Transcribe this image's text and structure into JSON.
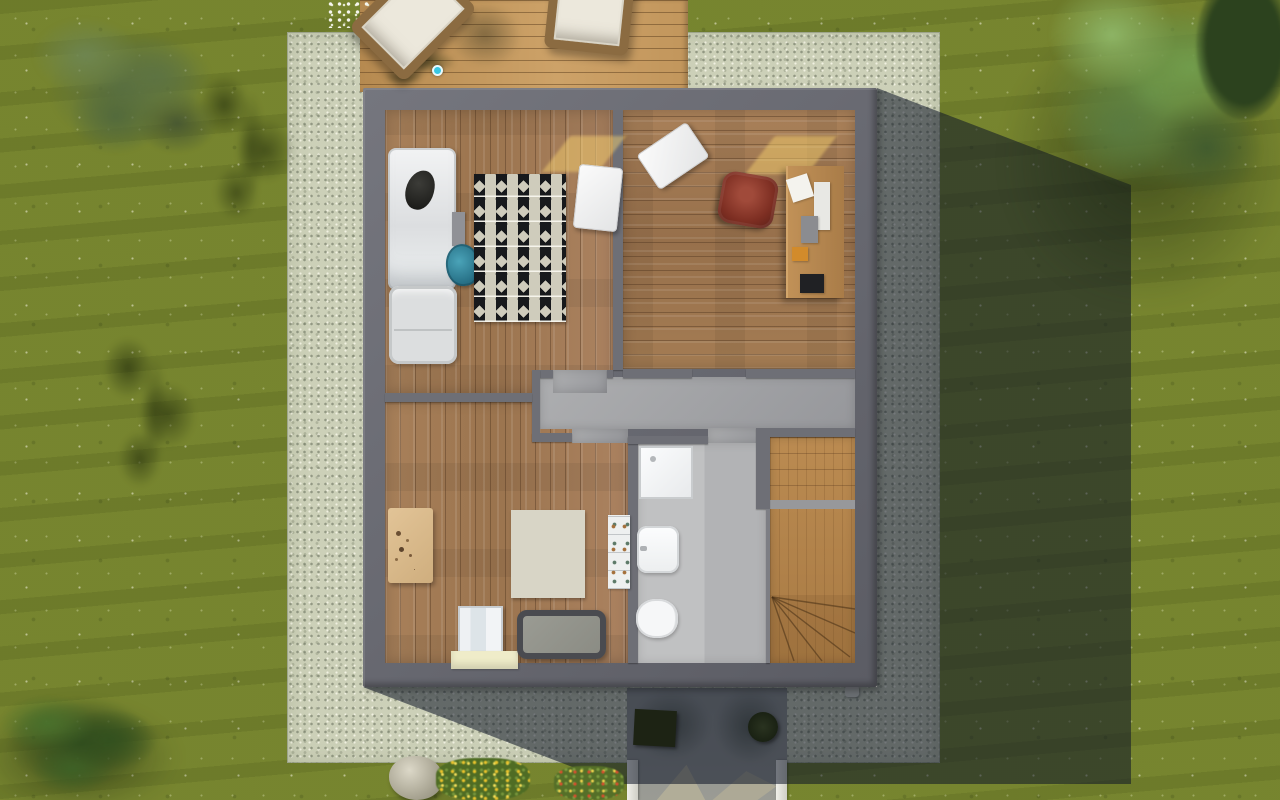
{
  "scene": {
    "view": "top-down-3d-render",
    "subject": "house-upper-floor-with-garden"
  },
  "palette": {
    "grass": "#75832e",
    "gravel": "#ccd0b8",
    "exterior_wall": "#65666e",
    "interior_wall": "#6e6f76",
    "wood_floor": "#a77f57",
    "deck_wood": "#c1955c",
    "hall_floor": "#a3a4a7",
    "bath_floor": "#b8b9bb",
    "stairs_wood": "#b5854d",
    "shadow": "rgba(13,20,38,0.55)",
    "camera_marker": "#39c7e3",
    "rug_zigzag_dark": "#17191c",
    "rug_zigzag_light": "#cfccbc"
  },
  "rug_patch_cells": [
    "#5d7a68",
    "#e8e6dd",
    "#6c8873",
    "#dfdfd6",
    "#c59056",
    "#d9ddd2",
    "#e4e2d8",
    "#c99a60",
    "#dcdcd2",
    "#c88f52",
    "#ece9df",
    "#567463",
    "#e7e5da",
    "#d8d8ce",
    "#c79355",
    "#e3e0d5"
  ],
  "objects": [
    {
      "name": "tree-shadow-upper-left",
      "cls": "shadow-blob",
      "x": 190,
      "y": 66,
      "w": 122,
      "h": 176,
      "interactable": false
    },
    {
      "name": "tree-shadow-middle-left",
      "cls": "shadow-blob",
      "x": 95,
      "y": 328,
      "w": 118,
      "h": 182,
      "interactable": false
    },
    {
      "name": "tree-shade-under-right-tree",
      "cls": "shade-soft",
      "x": 1000,
      "y": 10,
      "w": 290,
      "h": 300,
      "interactable": false
    },
    {
      "name": "bush-shadow",
      "cls": "shade-soft",
      "x": -25,
      "y": 700,
      "w": 205,
      "h": 115,
      "interactable": false
    },
    {
      "name": "lounger-shadow",
      "cls": "shade-soft-sm",
      "x": 448,
      "y": 2,
      "w": 74,
      "h": 66,
      "rot": 12,
      "interactable": false
    },
    {
      "name": "deck-branch-shadow",
      "cls": "shadow-blob",
      "x": 362,
      "y": 32,
      "w": 110,
      "h": 62,
      "interactable": false
    },
    {
      "name": "boulder",
      "cls": "boulder",
      "x": 389,
      "y": 756,
      "w": 54,
      "h": 44,
      "interactable": true
    },
    {
      "name": "flowerbed-yellow",
      "cls": "flowerbed-yellow",
      "x": 436,
      "y": 758,
      "w": 94,
      "h": 42,
      "interactable": true
    },
    {
      "name": "flowerbed-mixed",
      "cls": "flowerbed-mixed",
      "x": 554,
      "y": 766,
      "w": 70,
      "h": 34,
      "interactable": true
    },
    {
      "name": "bush-bottom-left",
      "cls": "bush",
      "x": -18,
      "y": 676,
      "w": 205,
      "h": 132,
      "interactable": true
    },
    {
      "name": "white-flowers-top",
      "cls": "flowers-white",
      "x": 326,
      "y": 0,
      "w": 48,
      "h": 28,
      "interactable": false
    },
    {
      "name": "sun-patch-bedroom",
      "cls": "sun-patch",
      "x": 556,
      "y": 136,
      "w": 56,
      "h": 36,
      "interactable": false
    },
    {
      "name": "bed",
      "cls": "bed",
      "x": 388,
      "y": 148,
      "w": 68,
      "h": 142,
      "interactable": true
    },
    {
      "name": "cat-on-bed",
      "cls": "cat",
      "x": 406,
      "y": 170,
      "w": 28,
      "h": 40,
      "rot": 14,
      "interactable": true
    },
    {
      "name": "bedside-table",
      "cls": "side-table",
      "x": 452,
      "y": 212,
      "w": 13,
      "h": 34,
      "interactable": true
    },
    {
      "name": "teal-chair",
      "cls": "chair-teal",
      "x": 446,
      "y": 244,
      "w": 34,
      "h": 42,
      "rot": -8,
      "interactable": true
    },
    {
      "name": "armchair",
      "cls": "armchair",
      "x": 389,
      "y": 286,
      "w": 68,
      "h": 78,
      "interactable": true
    },
    {
      "name": "zigzag-rug",
      "cls": "rug-zigzag",
      "x": 474,
      "y": 174,
      "w": 92,
      "h": 148,
      "interactable": true
    },
    {
      "name": "bedroom-white-table",
      "cls": "table-white",
      "x": 576,
      "y": 166,
      "w": 44,
      "h": 64,
      "rot": 6,
      "interactable": true
    },
    {
      "name": "sun-patch-office",
      "cls": "sun-patch",
      "x": 760,
      "y": 136,
      "w": 62,
      "h": 38,
      "interactable": false
    },
    {
      "name": "office-white-table",
      "cls": "table-white",
      "x": 643,
      "y": 135,
      "w": 60,
      "h": 42,
      "rot": -34,
      "interactable": true
    },
    {
      "name": "office-chair-red",
      "cls": "chair-red",
      "x": 720,
      "y": 174,
      "w": 56,
      "h": 52,
      "rot": 10,
      "interactable": true
    },
    {
      "name": "office-desk",
      "cls": "desk",
      "x": 786,
      "y": 166,
      "w": 58,
      "h": 132,
      "interactable": true
    },
    {
      "name": "desk-paper",
      "cls": "item",
      "x": 789,
      "y": 176,
      "w": 22,
      "h": 24,
      "rot": -18,
      "color": "#f4f3ee",
      "interactable": true
    },
    {
      "name": "desk-documents",
      "cls": "item",
      "x": 814,
      "y": 182,
      "w": 16,
      "h": 48,
      "color": "#e8e8e4",
      "interactable": true
    },
    {
      "name": "under-desk-unit",
      "cls": "item",
      "x": 801,
      "y": 216,
      "w": 17,
      "h": 27,
      "color": "#8b8c90",
      "interactable": true
    },
    {
      "name": "orange-box",
      "cls": "item",
      "x": 792,
      "y": 247,
      "w": 16,
      "h": 14,
      "color": "#d28b2b",
      "interactable": true
    },
    {
      "name": "desk-mat-black",
      "cls": "item",
      "x": 800,
      "y": 274,
      "w": 24,
      "h": 19,
      "color": "#202124",
      "interactable": true
    },
    {
      "name": "kids-table",
      "cls": "kids-table",
      "x": 388,
      "y": 508,
      "w": 45,
      "h": 75,
      "interactable": true
    },
    {
      "name": "patchwork-rug",
      "cls": "rug-patch",
      "x": 511,
      "y": 510,
      "w": 74,
      "h": 88,
      "interactable": true
    },
    {
      "name": "kids-wardrobe",
      "cls": "wardrobe",
      "x": 458,
      "y": 606,
      "w": 45,
      "h": 48,
      "interactable": true
    },
    {
      "name": "cream-shelf",
      "cls": "shelf-cream",
      "x": 451,
      "y": 651,
      "w": 67,
      "h": 18,
      "interactable": true
    },
    {
      "name": "crib-bed",
      "cls": "crib",
      "x": 517,
      "y": 610,
      "w": 89,
      "h": 49,
      "interactable": true
    },
    {
      "name": "toy-shelf",
      "cls": "toy-shelf",
      "x": 608,
      "y": 515,
      "w": 22,
      "h": 74,
      "interactable": true
    },
    {
      "name": "shower-tray",
      "cls": "shower",
      "x": 639,
      "y": 446,
      "w": 54,
      "h": 53,
      "interactable": true
    },
    {
      "name": "bathroom-sink",
      "cls": "sink",
      "x": 637,
      "y": 526,
      "w": 42,
      "h": 47,
      "interactable": true
    },
    {
      "name": "toilet",
      "cls": "toilet",
      "x": 636,
      "y": 599,
      "w": 42,
      "h": 39,
      "interactable": true
    },
    {
      "name": "porch-plant-left-pot",
      "cls": "plant-pot",
      "x": 634,
      "y": 710,
      "w": 42,
      "h": 36,
      "rot": 3,
      "interactable": true
    },
    {
      "name": "porch-plant-left",
      "cls": "plant-leaves",
      "x": 612,
      "y": 688,
      "w": 95,
      "h": 88,
      "interactable": true
    },
    {
      "name": "porch-plant-right-pot",
      "cls": "plant-pot-round",
      "x": 748,
      "y": 712,
      "w": 30,
      "h": 30,
      "interactable": true
    },
    {
      "name": "porch-plant-right",
      "cls": "plant-leaves",
      "x": 722,
      "y": 686,
      "w": 76,
      "h": 88,
      "rot": 40,
      "interactable": true
    },
    {
      "name": "sun-lounger-left",
      "cls": "lounger",
      "x": 374,
      "y": -34,
      "w": 78,
      "h": 104,
      "rot": 45,
      "interactable": true
    },
    {
      "name": "sun-lounger-right",
      "cls": "lounger",
      "x": 548,
      "y": -34,
      "w": 84,
      "h": 86,
      "rot": 6,
      "interactable": true
    },
    {
      "name": "camera-marker",
      "cls": "marker-camera",
      "x": 432,
      "y": 65,
      "w": 11,
      "h": 11,
      "interactable": true
    },
    {
      "name": "tree-top-left",
      "cls": "tree tree-olive",
      "x": 20,
      "y": 2,
      "w": 218,
      "h": 178,
      "interactable": true
    },
    {
      "name": "palm-plant",
      "cls": "palm",
      "x": 256,
      "y": 0,
      "w": 116,
      "h": 196,
      "interactable": true
    },
    {
      "name": "tree-top-right",
      "cls": "tree tree-bright",
      "x": 1012,
      "y": -40,
      "w": 278,
      "h": 268,
      "interactable": true
    },
    {
      "name": "tree-dark-corner",
      "cls": "tree tree-dark",
      "x": 1196,
      "y": -30,
      "w": 96,
      "h": 150,
      "interactable": true
    }
  ]
}
